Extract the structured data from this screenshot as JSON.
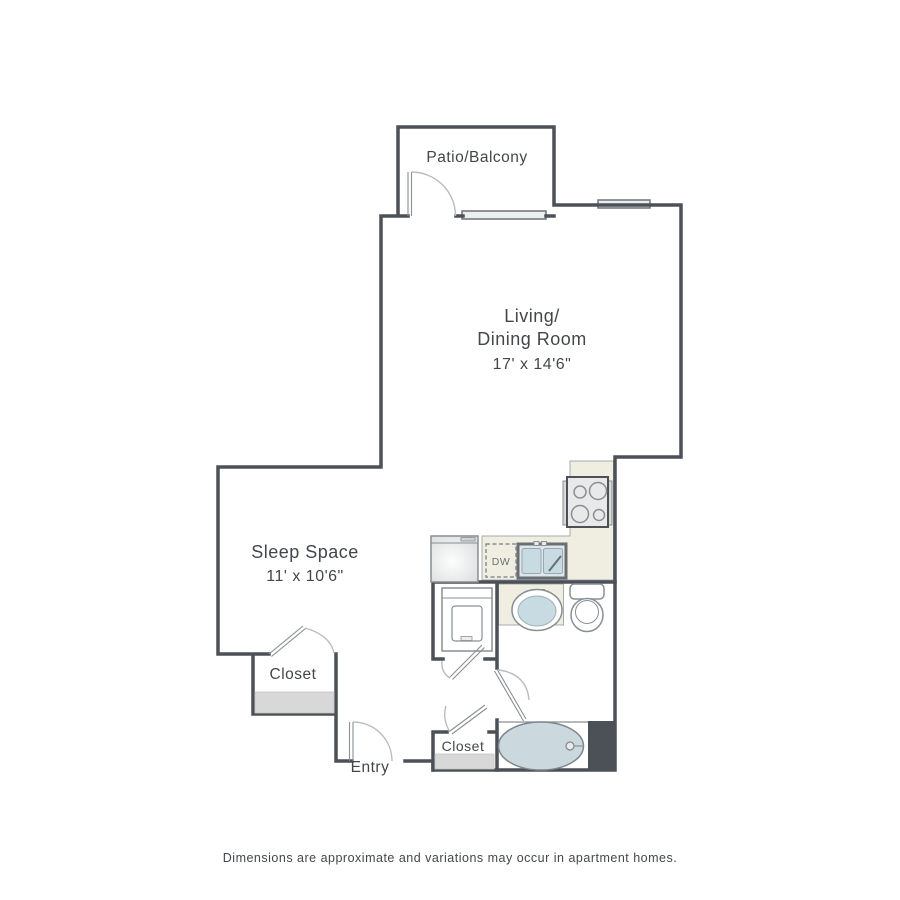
{
  "colors": {
    "wall": "#4b5157",
    "counter": "#efeee1",
    "counter-border": "#a6aca9",
    "fixture-line": "#8a8f94",
    "water": "#c8dae2",
    "tub": "#cbd9de",
    "shelf": "#d8d8d8",
    "window-fill": "#eceff0",
    "door-arc": "#b9bcbe",
    "text": "#43474b",
    "text-muted": "#6d7277"
  },
  "floor_plan": {
    "patio": {
      "label": "Patio/Balcony"
    },
    "living_dining": {
      "label_line1": "Living/",
      "label_line2": "Dining Room",
      "dimensions": "17' x 14'6\""
    },
    "sleep_space": {
      "label": "Sleep Space",
      "dimensions": "11' x 10'6\""
    },
    "closet_bedroom": {
      "label": "Closet"
    },
    "closet_hall": {
      "label": "Closet"
    },
    "entry": {
      "label": "Entry"
    },
    "dishwasher": {
      "label": "DW"
    },
    "disclaimer": "Dimensions are approximate and variations may occur in apartment homes."
  }
}
